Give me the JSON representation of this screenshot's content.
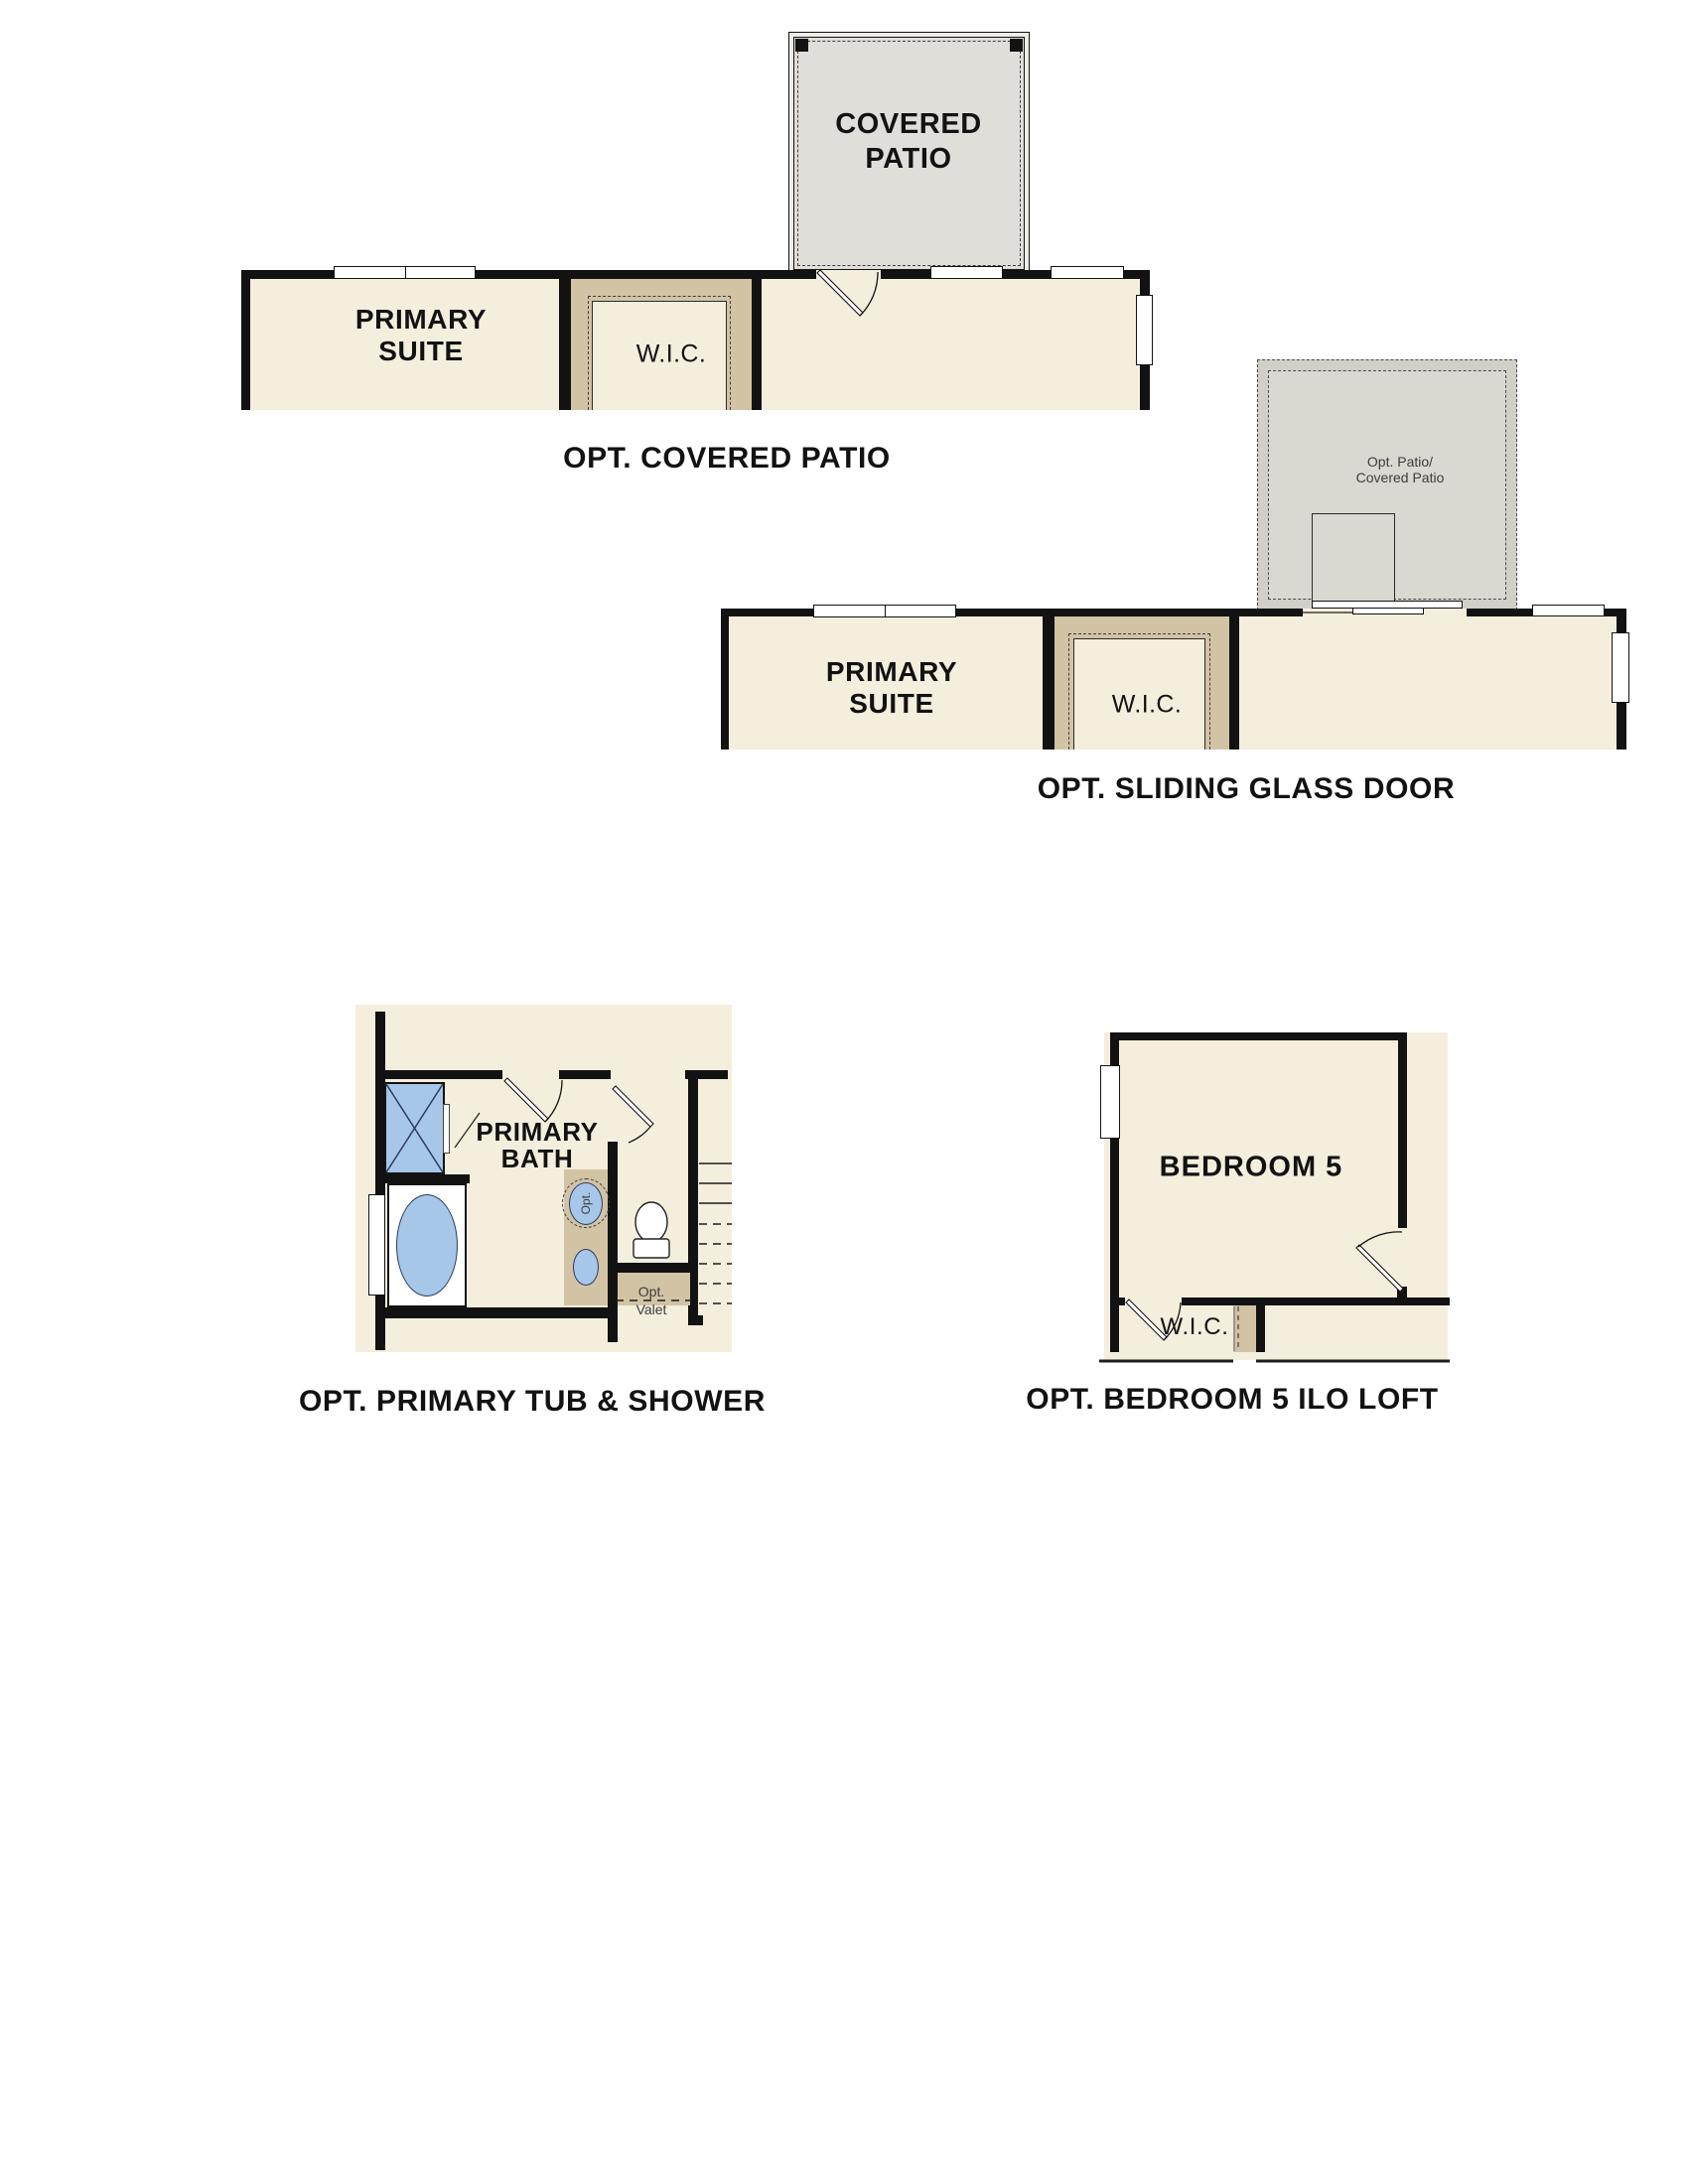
{
  "colors": {
    "wall": "#121212",
    "cream": "#f4eedd",
    "tan": "#d3c3a5",
    "patioFill": "#e1deda",
    "patioBand": "#eeece8",
    "patio2Fill": "#dbd8d2",
    "patio2Band": "#d2cfc8",
    "blue": "#a7c7e8",
    "fixline": "#2c3a66",
    "text": "#121212",
    "subtext": "#3c3c3c"
  },
  "s1": {
    "caption": "OPT. COVERED PATIO",
    "suite_line1": "PRIMARY",
    "suite_line2": "SUITE",
    "wic": "W.I.C.",
    "patio_line1": "COVERED",
    "patio_line2": "PATIO"
  },
  "s2": {
    "caption": "OPT. SLIDING GLASS DOOR",
    "suite_line1": "PRIMARY",
    "suite_line2": "SUITE",
    "wic": "W.I.C.",
    "note_line1": "Opt. Patio/",
    "note_line2": "Covered Patio"
  },
  "s3": {
    "caption": "OPT. PRIMARY TUB & SHOWER",
    "bath_line1": "PRIMARY",
    "bath_line2": "BATH",
    "opt_rotated": "Opt.",
    "valet_line1": "Opt.",
    "valet_line2": "Valet"
  },
  "s4": {
    "caption": "OPT. BEDROOM 5 ILO LOFT",
    "bedroom": "BEDROOM 5",
    "wic": "W.I.C."
  }
}
